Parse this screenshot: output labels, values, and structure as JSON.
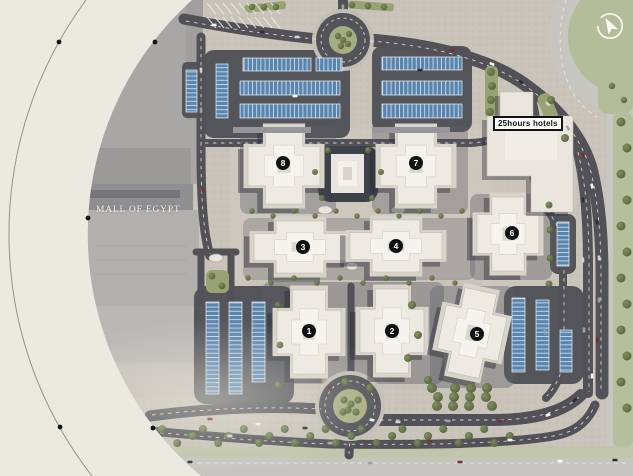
{
  "page": {
    "background_color": "#ebeae1"
  },
  "map": {
    "name": "Mall of Egypt masterplan site map",
    "landmarks": {
      "mall_label": "MALL OF EGYPT",
      "hotel_label": "25hours hotels"
    },
    "building_markers": [
      {
        "number": "1"
      },
      {
        "number": "2"
      },
      {
        "number": "3"
      },
      {
        "number": "4"
      },
      {
        "number": "5"
      },
      {
        "number": "6"
      },
      {
        "number": "7"
      },
      {
        "number": "8"
      }
    ],
    "icons": {
      "compass": "north-arrow"
    },
    "colors": {
      "background": "#ebeae1",
      "asphalt": "#53545a",
      "pavement": "#c9c3ba",
      "parking_canopy": "#5c85ae",
      "greenery": "#66754a",
      "grass": "#b6bf9b",
      "mall_roof": "#a8a7a5",
      "building_roof": "#edeae3",
      "marker": "#111111"
    }
  }
}
